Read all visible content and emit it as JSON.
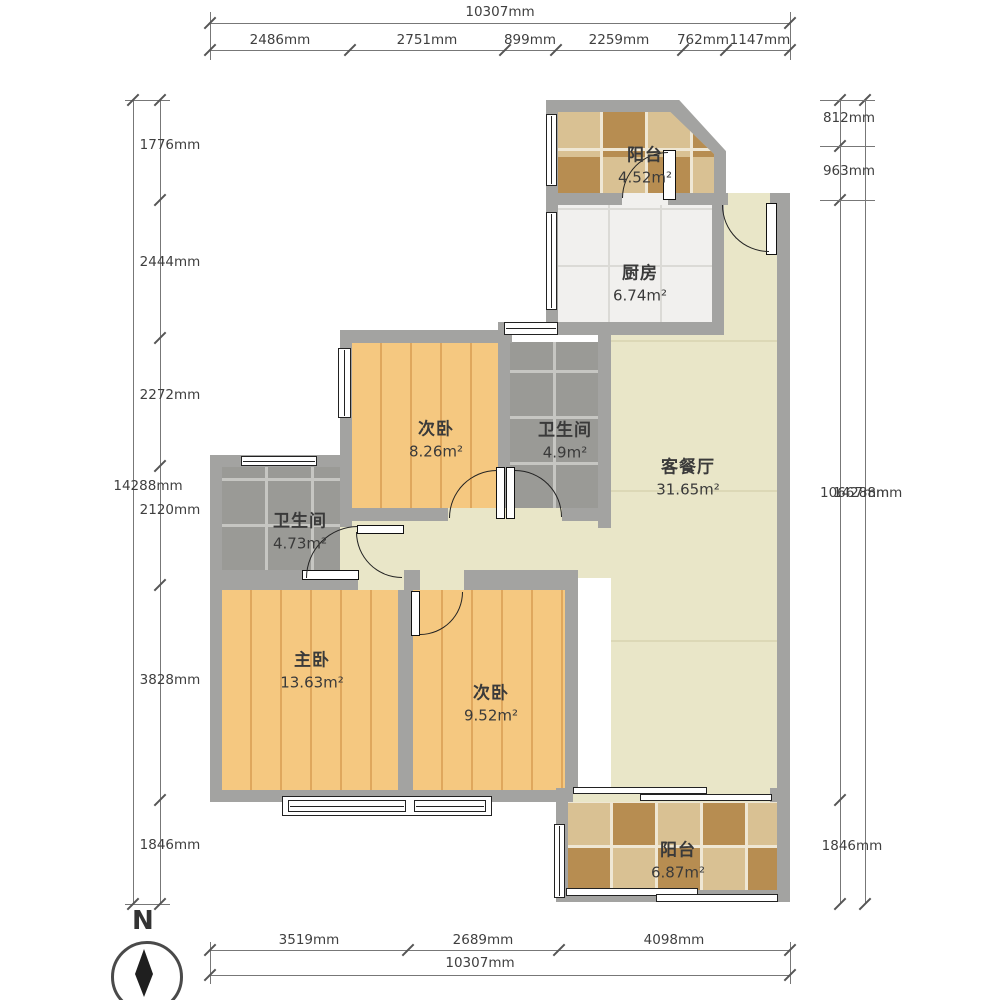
{
  "dimensions": {
    "top": {
      "total": "10307mm",
      "segments": [
        "2486mm",
        "2751mm",
        "899mm",
        "2259mm",
        "762mm",
        "1147mm"
      ]
    },
    "bottom": {
      "total": "10307mm",
      "segments": [
        "3519mm",
        "2689mm",
        "4098mm"
      ]
    },
    "left": {
      "total": "14288mm",
      "segments": [
        "1776mm",
        "2444mm",
        "2272mm",
        "2120mm",
        "3828mm",
        "1846mm"
      ]
    },
    "right": {
      "total": "14288mm",
      "segments": [
        "812mm",
        "963mm",
        "10667mm",
        "1846mm"
      ]
    }
  },
  "rooms": [
    {
      "id": "balcony-top",
      "name": "阳台",
      "area": "4.52m²"
    },
    {
      "id": "kitchen",
      "name": "厨房",
      "area": "6.74m²"
    },
    {
      "id": "bedroom-second",
      "name": "次卧",
      "area": "8.26m²"
    },
    {
      "id": "bathroom-east",
      "name": "卫生间",
      "area": "4.9m²"
    },
    {
      "id": "living-dining",
      "name": "客餐厅",
      "area": "31.65m²"
    },
    {
      "id": "bathroom-west",
      "name": "卫生间",
      "area": "4.73m²"
    },
    {
      "id": "master-bedroom",
      "name": "主卧",
      "area": "13.63m²"
    },
    {
      "id": "bedroom-third",
      "name": "次卧",
      "area": "9.52m²"
    },
    {
      "id": "balcony-bottom",
      "name": "阳台",
      "area": "6.87m²"
    }
  ],
  "compass": {
    "label": "N"
  },
  "colors": {
    "wall": "#a3a3a1",
    "wood_floor": "#f5c880",
    "wood_line": "#dfa75d",
    "tile_gray": "#9a9a96",
    "tile_grout": "#c6c6c2",
    "living_floor": "#e9e6c8",
    "kitchen_floor": "#f1f0ee",
    "balcony_light": "#d9c193",
    "balcony_dark": "#b78d51",
    "dim_text": "#3f3f3f",
    "line": "#777777"
  }
}
